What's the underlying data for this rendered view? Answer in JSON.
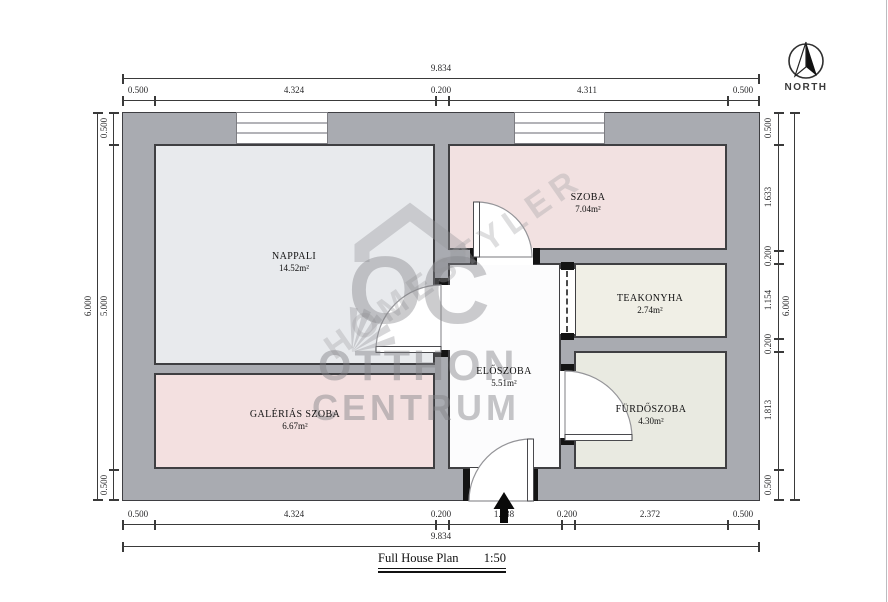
{
  "plan": {
    "title": "Full House Plan",
    "scale": "1:50",
    "north_label": "NORTH"
  },
  "rooms": {
    "nappali": {
      "name": "NAPPALI",
      "area": "14.52m²"
    },
    "szoba": {
      "name": "SZOBA",
      "area": "7.04m²"
    },
    "teakonyha": {
      "name": "TEAKONYHA",
      "area": "2.74m²"
    },
    "eloszoba": {
      "name": "ELŐSZOBA",
      "area": "5.51m²"
    },
    "furdoszoba": {
      "name": "FÜRDŐSZOBA",
      "area": "4.30m²"
    },
    "galerias_szoba": {
      "name": "GALÉRIÁS SZOBA",
      "area": "6.67m²"
    }
  },
  "dimensions": {
    "top": {
      "overall": "9.834",
      "segments": [
        "0.500",
        "4.324",
        "0.200",
        "4.311",
        "0.500"
      ]
    },
    "bottom": {
      "overall": "9.834",
      "segments": [
        "0.500",
        "4.324",
        "0.200",
        "1.738",
        "0.200",
        "2.372",
        "0.500"
      ]
    },
    "left": {
      "overall": "6.000",
      "segments": [
        "0.500",
        "5.000",
        "0.500"
      ]
    },
    "right": {
      "overall": "6.000",
      "segments": [
        "0.500",
        "1.633",
        "0.200",
        "1.154",
        "0.200",
        "1.813",
        "0.500"
      ]
    }
  },
  "watermark": {
    "logo": "OC",
    "diagonal": "HOMESTYLER",
    "brand_line1": "OTTHON",
    "brand_line2": "CENTRUM"
  },
  "colors": {
    "wall": "#a9abb1",
    "nappali_floor": "#e8eaed",
    "szoba_floor": "#f2e1e1",
    "galerias_floor": "#f3e0e0",
    "teakonyha_floor": "#f0efe6",
    "furdoszoba_floor": "#e9eae1",
    "eloszoba_floor": "#fcfcfd"
  }
}
